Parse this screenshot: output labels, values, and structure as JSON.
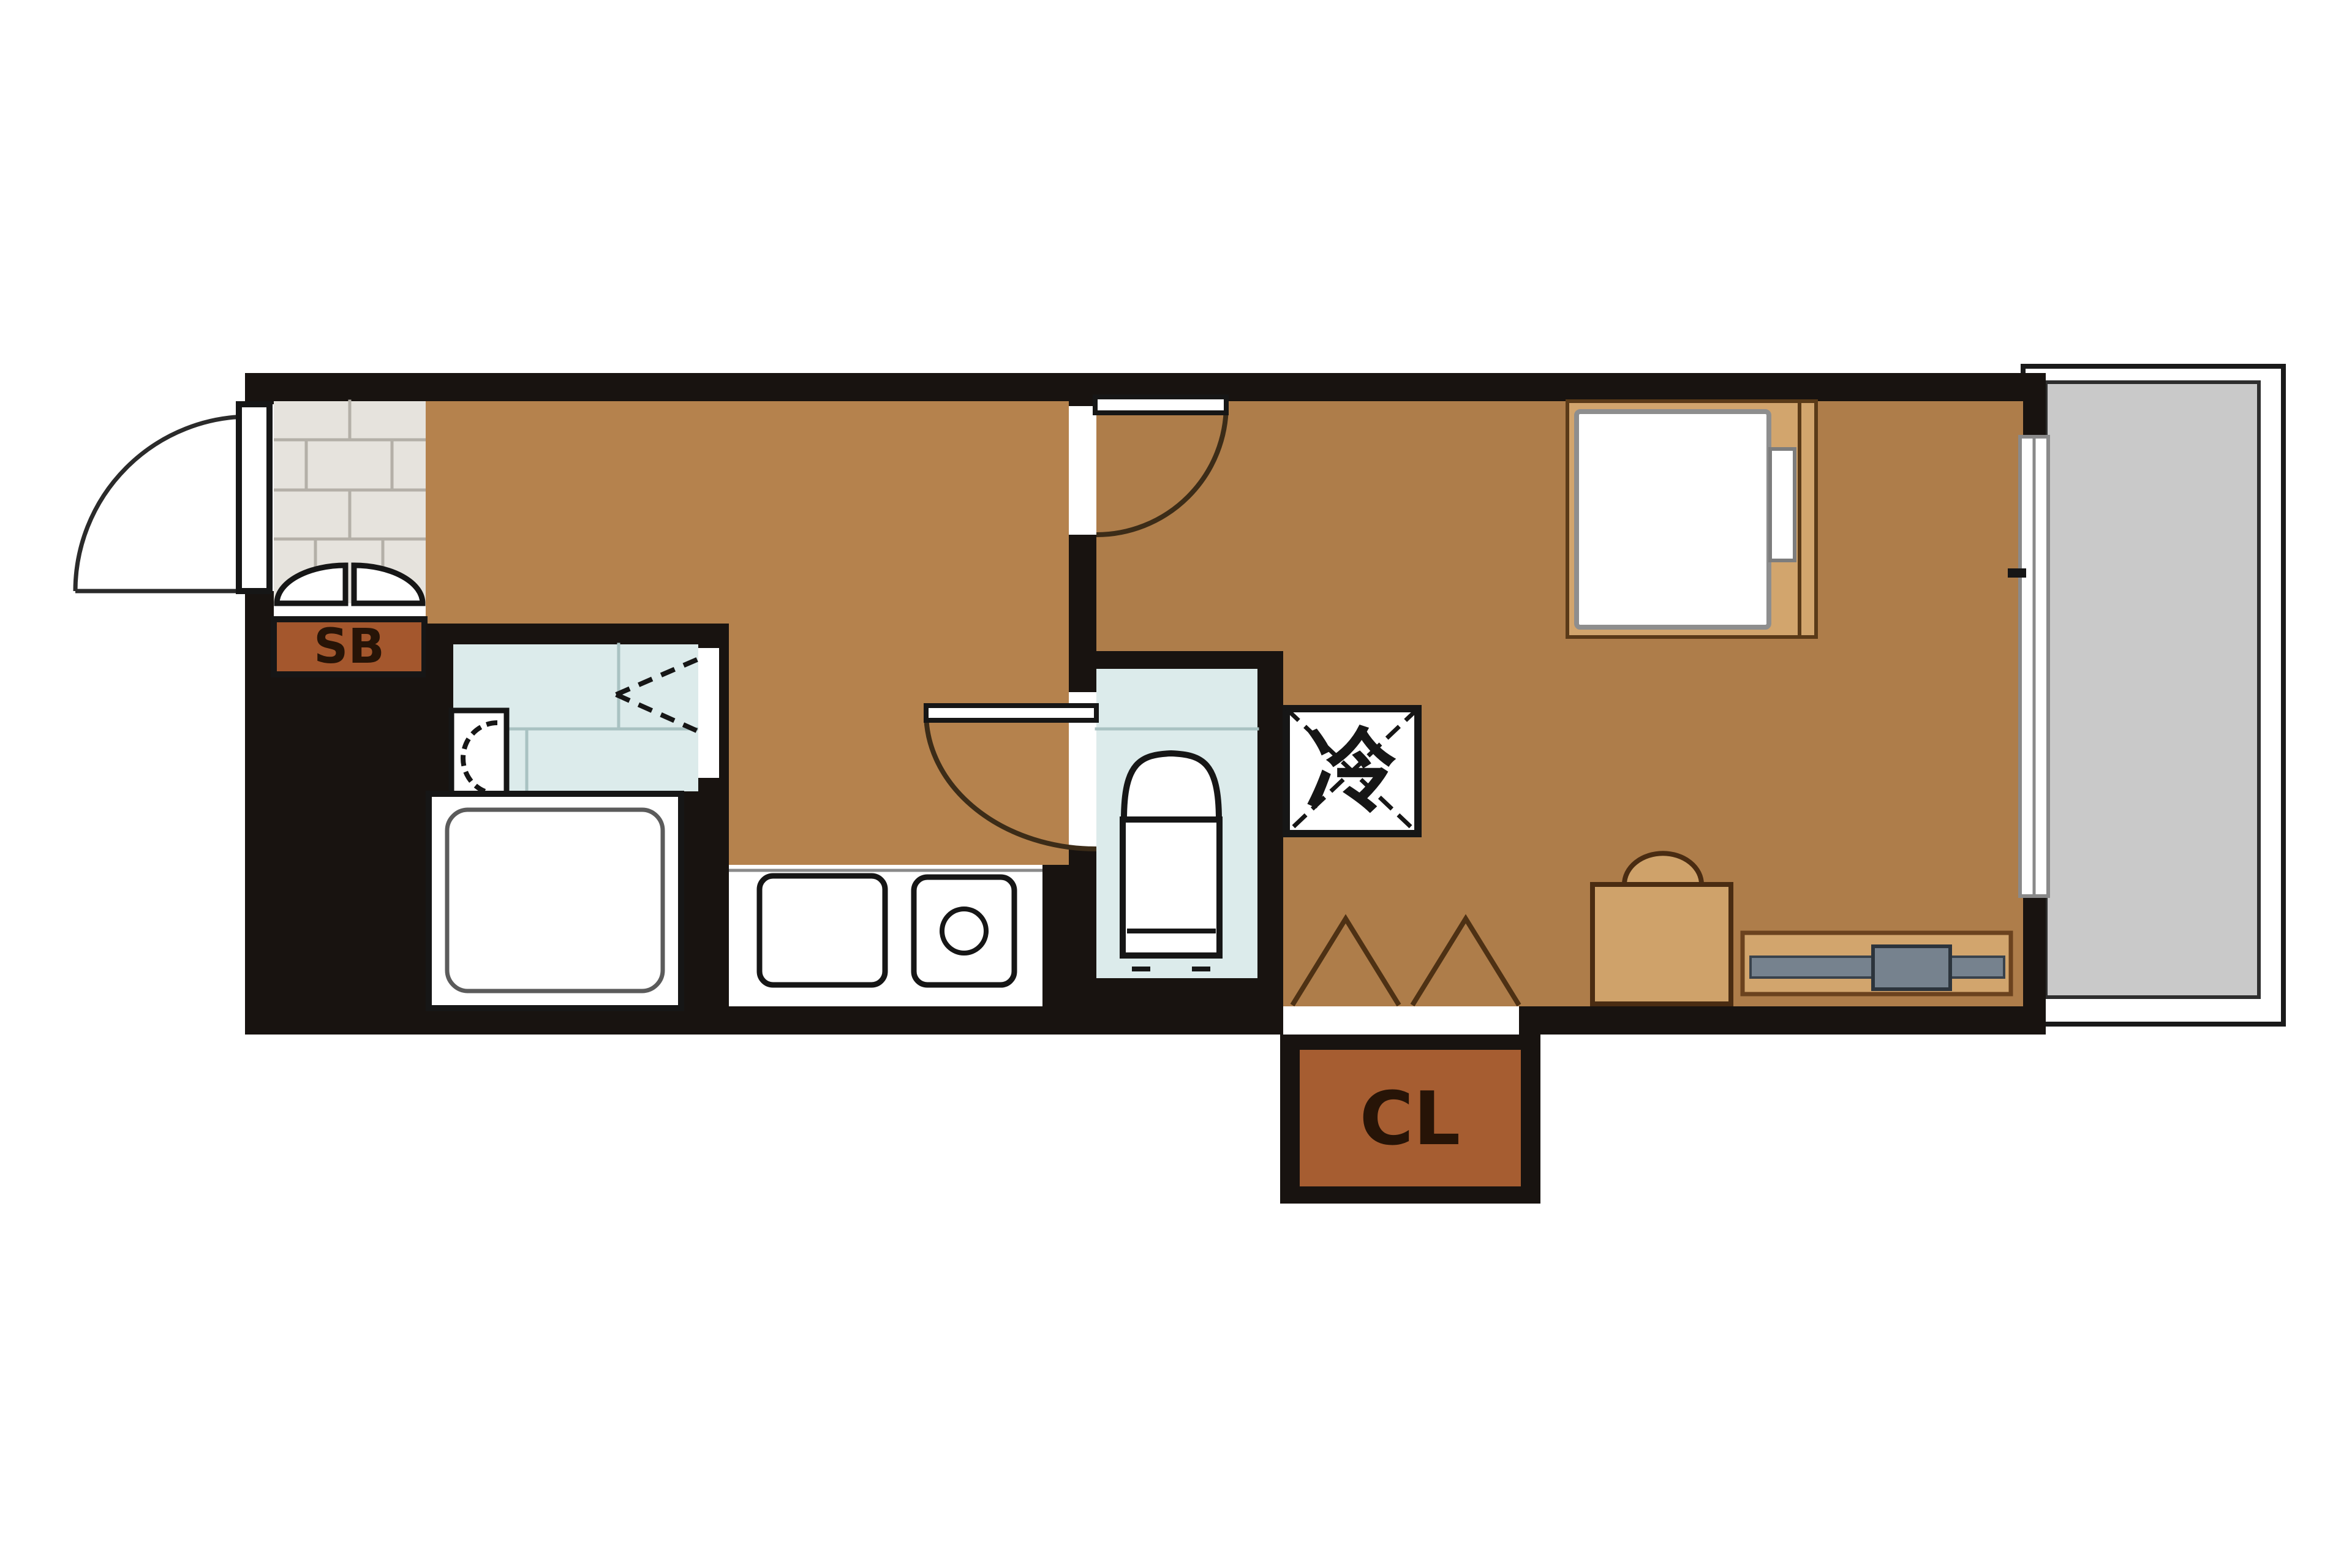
{
  "plan": {
    "labels": {
      "shoe_box": "SB",
      "closet": "CL",
      "refrigerator": "冷"
    },
    "colors": {
      "background": "#ffffff",
      "wall": "#181310",
      "kitchen_floor": "#b5824d",
      "bedroom_floor": "#ae7d4a",
      "genkan_tile": "#e6e3dd",
      "tile_line": "#b4b0a8",
      "bathroom_floor": "#dcebeb",
      "bath_tile_line": "#a9c2c2",
      "balcony_floor": "#c9c9c9",
      "shoe_box_fill": "#a4572d",
      "closet_fill": "#a65d31",
      "label_text": "#271407",
      "bed_platform": "#d2a56d",
      "mattress_white": "#ffffff",
      "furniture_tan": "#cfa26a",
      "tv_gray": "#76828e",
      "fixture_white": "#ffffff",
      "swing_line": "#3c2c18",
      "window_line": "#8a8a8a"
    }
  }
}
